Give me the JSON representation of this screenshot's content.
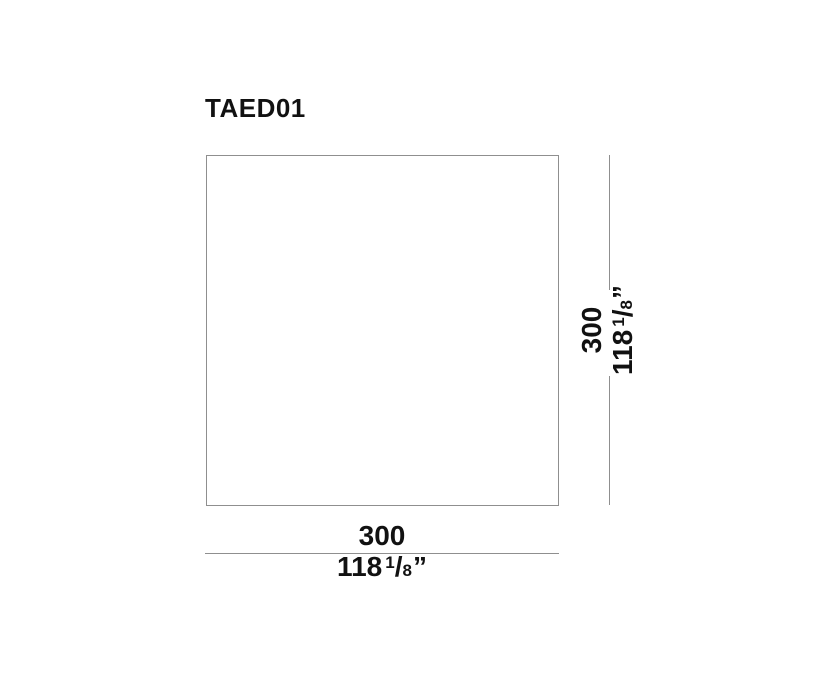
{
  "title": "TAED01",
  "drawing": {
    "shape": "square-panel-outline",
    "width_dimension": {
      "mm": "300",
      "imperial": {
        "whole": "118",
        "numerator": "1",
        "slash": "/",
        "denominator": "8",
        "unit": "”"
      }
    },
    "height_dimension": {
      "mm": "300",
      "imperial": {
        "whole": "118",
        "numerator": "1",
        "slash": "/",
        "denominator": "8",
        "unit": "”"
      }
    }
  },
  "colors": {
    "background": "#ffffff",
    "line": "#8f8f8f",
    "text": "#111111"
  }
}
